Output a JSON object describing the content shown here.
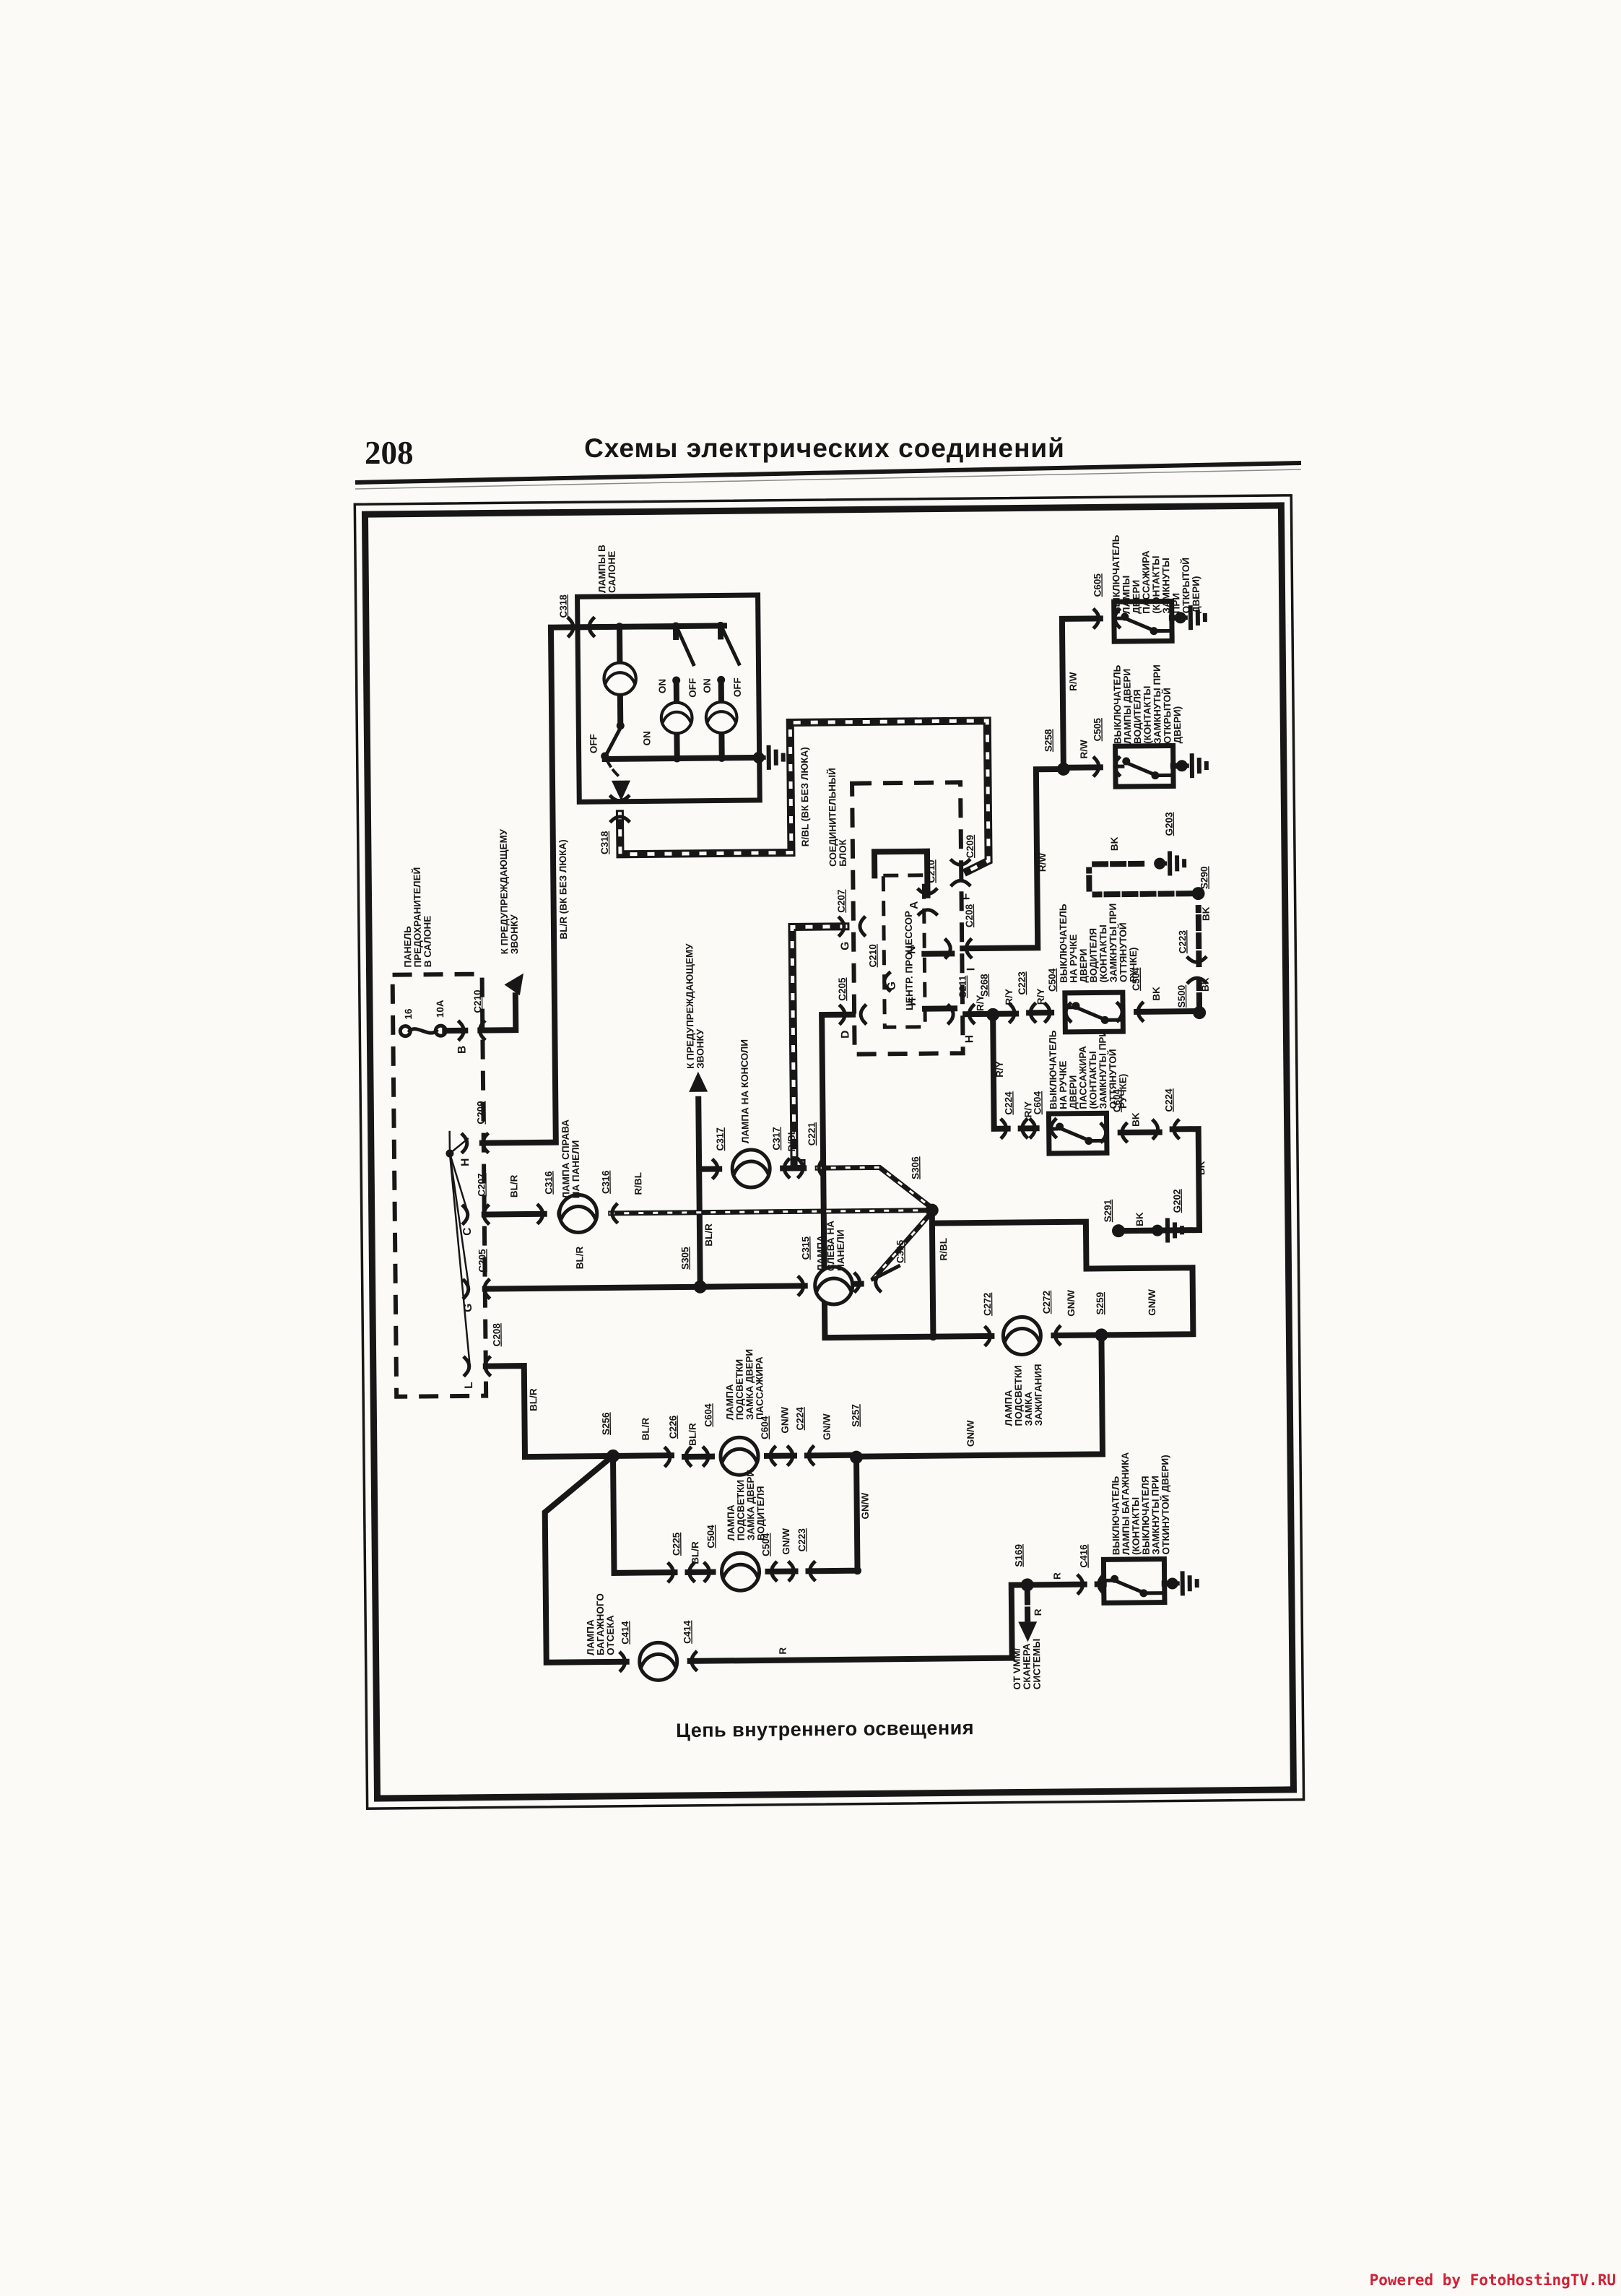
{
  "page": {
    "number": "208",
    "title": "Схемы  электрических  соединений",
    "watermark": "Powered by FotoHostingTV.RU"
  },
  "diagram": {
    "caption": "Цепь внутреннего освещения",
    "labels": {
      "lamps_salon": "ЛАМПЫ В\nСАЛОНЕ",
      "fuse_panel": "ПАНЕЛЬ\nПРЕДОХРАНИТЕЛЕЙ\nВ САЛОНЕ",
      "fuse_num": "16",
      "fuse_amp": "10А",
      "chime": "К ПРЕДУПРЕЖДАЮЩЕМУ\nЗВОНКУ",
      "junction_block": "СОЕДИНИТЕЛЬНЫЙ\nБЛОК",
      "cpu": "ЦЕНТР. ПРОЦЕССОР",
      "lamp_right": "ЛАМПА СПРАВА\nНА ПАНЕЛИ",
      "lamp_console": "ЛАМПА НА КОНСОЛИ",
      "lamp_left": "ЛАМПА\nСЛЕВА НА\nПАНЕЛИ",
      "lamp_pass_lock": "ЛАМПА\nПОДСВЕТКИ\nЗАМКА ДВЕРИ\nПАССАЖИРА",
      "lamp_drv_lock": "ЛАМПА\nПОДСВЕТКИ\nЗАМКА ДВЕРИ\nВОДИТЕЛЯ",
      "lamp_ign": "ЛАМПА\nПОДСВЕТКИ\nЗАМКА\nЗАЖИГАНИЯ",
      "lamp_trunk": "ЛАМПА\nБАГАЖНОГО\nОТСЕКА",
      "sw_pass_door": "ВЫКЛЮЧАТЕЛЬ\nЛАМПЫ\nДВЕРИ\nПАССАЖИРА\n(КОНТАКТЫ\nЗАМКНУТЫ\nПРИ\nОТКРЫТОЙ\nДВЕРИ)",
      "sw_drv_door": "ВЫКЛЮЧАТЕЛЬ\nЛАМПЫ ДВЕРИ\nВОДИТЕЛЯ\n(КОНТАКТЫ\nЗАМКНУТЫ ПРИ\nОТКРЫТОЙ\nДВЕРИ)",
      "sw_drv_handle": "ВЫКЛЮЧАТЕЛЬ\nНА РУЧКЕ\nДВЕРИ\nВОДИТЕЛЯ\n(КОНТАКТЫ\nЗАМКНУТЫ ПРИ\nОТТЯНУТОЙ\nРУЧКЕ)",
      "sw_pass_handle": "ВЫКЛЮЧАТЕЛЬ\nНА РУЧКЕ\nДВЕРИ\nПАССАЖИРА\n(КОНТАКТЫ\nЗАМКНУТЫ ПРИ\nОТТЯНУТОЙ\nРУЧКЕ)",
      "sw_trunk": "ВЫКЛЮЧАТЕЛЬ\nЛАМПЫ БАГАЖНИКА\n(КОНТАКТЫ\nВЫКЛЮЧАТЕЛЯ\nЗАМКНУТЫ ПРИ\nОТКИНУТОЙ ДВЕРИ)",
      "vmm": "ОТ VMM/\nСКАНЕРА\nСИСТЕМЫ",
      "blr": "BL/R",
      "rbl": "R/BL",
      "gnw": "GN/W",
      "ry": "R/Y",
      "rw": "R/W",
      "bk": "BK",
      "r": "R",
      "blr_note": "BL/R (ВК БЕЗ ЛЮКА)",
      "rbl_note": "R/BL (ВК БЕЗ ЛЮКА)",
      "on": "ON",
      "off": "OFF",
      "c205": "C205",
      "c207": "C207",
      "c208": "C208",
      "c209": "C209",
      "c210": "C210",
      "c211": "C211",
      "c221": "C221",
      "c223": "C223",
      "c224": "C224",
      "c225": "C225",
      "c226": "C226",
      "c272": "C272",
      "c315": "C315",
      "c316": "C316",
      "c317": "C317",
      "c318": "C318",
      "c414": "C414",
      "c416": "C416",
      "c504": "C504",
      "c505": "C505",
      "c604": "C604",
      "c605": "C605",
      "s169": "S169",
      "s256": "S256",
      "s257": "S257",
      "s258": "S258",
      "s259": "S259",
      "s268": "S268",
      "s290": "S290",
      "s291": "S291",
      "s305": "S305",
      "s306": "S306",
      "s500": "S500",
      "g202": "G202",
      "g203": "G203",
      "pin_a": "A",
      "pin_b": "B",
      "pin_c": "C",
      "pin_d": "D",
      "pin_f": "F",
      "pin_g": "G",
      "pin_h": "H",
      "pin_i": "I",
      "pin_l": "L",
      "pin_n": "N"
    }
  }
}
